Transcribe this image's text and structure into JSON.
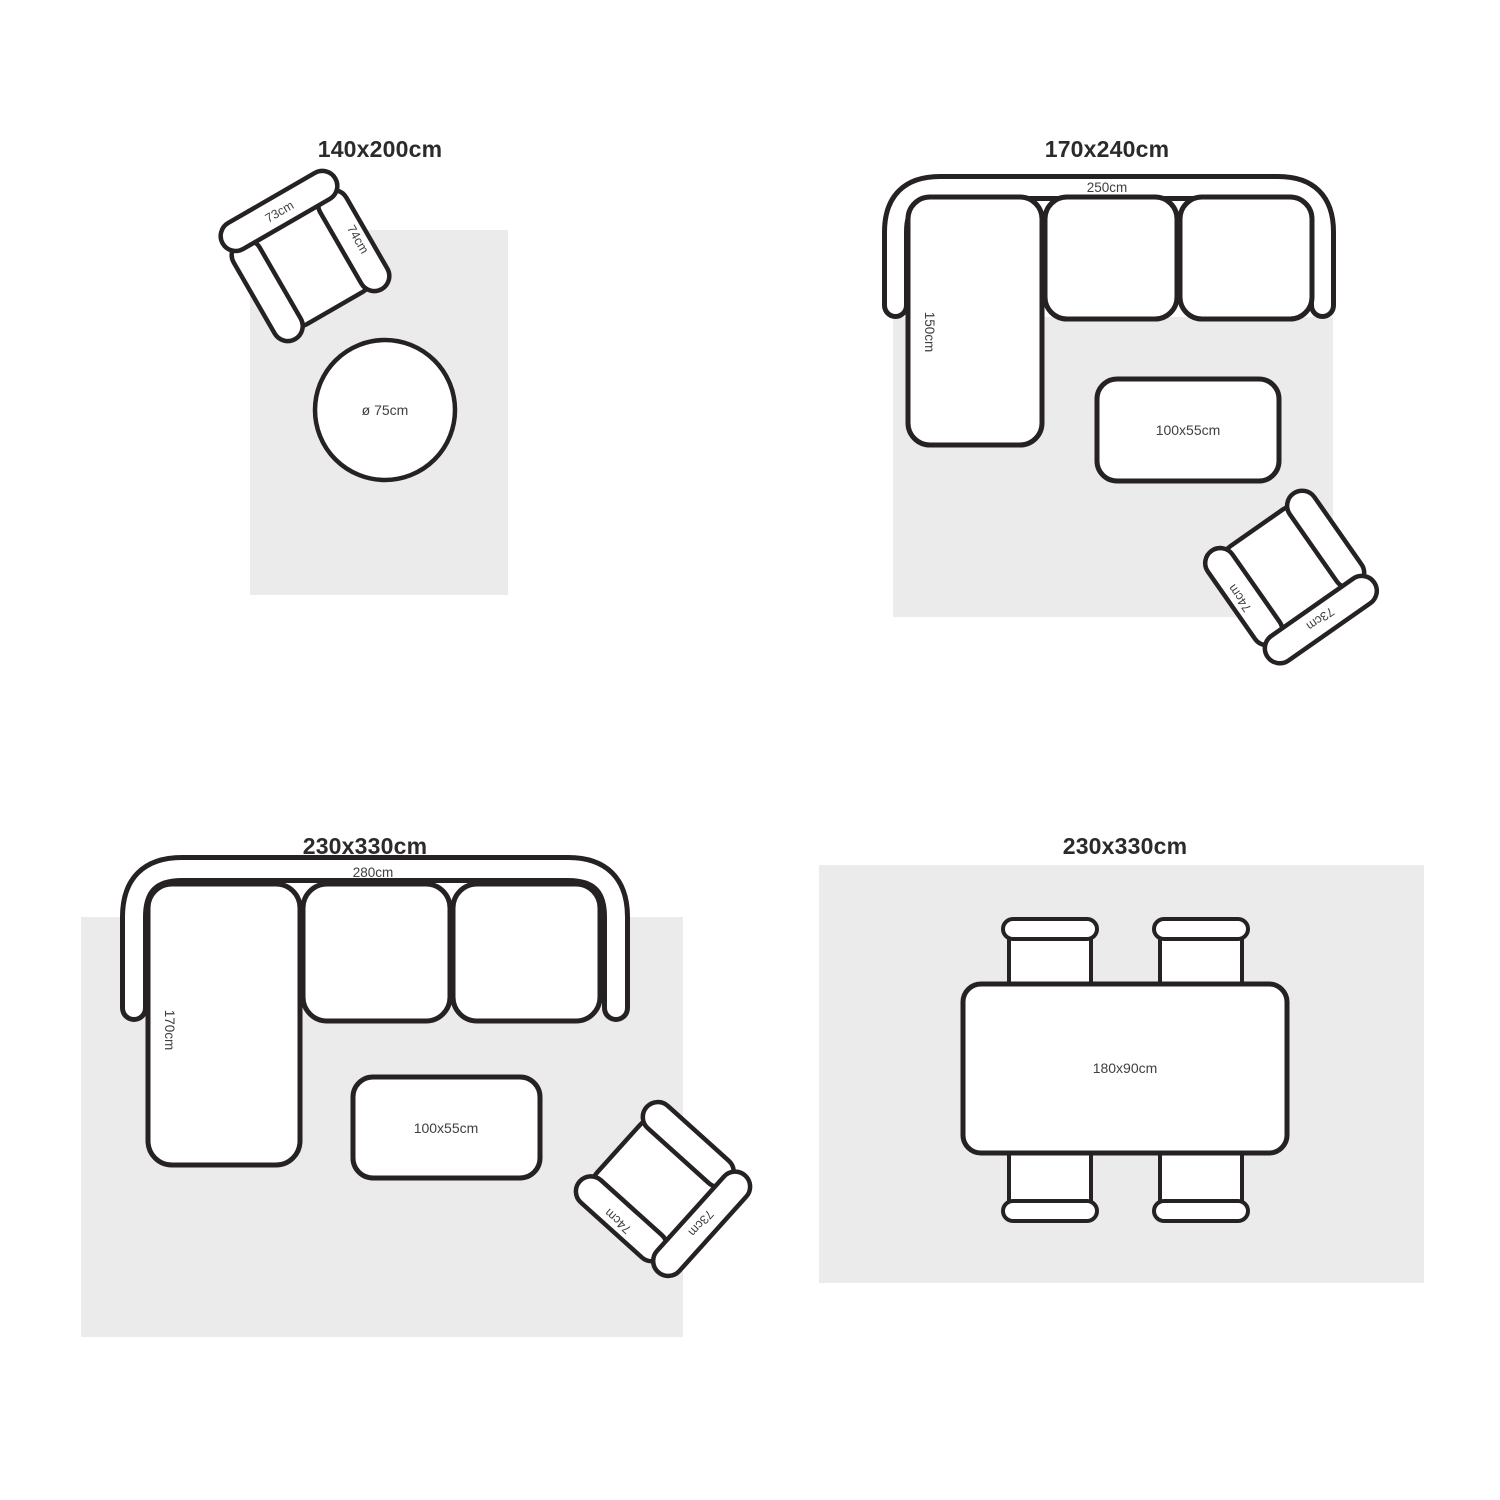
{
  "canvas": {
    "width": 1500,
    "height": 1500,
    "background": "#ffffff"
  },
  "colors": {
    "line": "#262223",
    "rug": "#ebebeb",
    "label": "#3f3f3f",
    "title": "#2b2b2b"
  },
  "quadrants": [
    {
      "id": "top-left",
      "title": "140x200cm",
      "armchair": {
        "back_label": "73cm",
        "arm_label": "74cm"
      },
      "round_table_label": "ø 75cm"
    },
    {
      "id": "top-right",
      "title": "170x240cm",
      "sofa": {
        "width_label": "250cm",
        "depth_label": "150cm"
      },
      "coffee_table_label": "100x55cm",
      "armchair": {
        "back_label": "73cm",
        "arm_label": "74cm"
      }
    },
    {
      "id": "bottom-left",
      "title": "230x330cm",
      "sofa": {
        "width_label": "280cm",
        "depth_label": "170cm"
      },
      "coffee_table_label": "100x55cm",
      "armchair": {
        "back_label": "73cm",
        "arm_label": "74cm"
      }
    },
    {
      "id": "bottom-right",
      "title": "230x330cm",
      "dining_table_label": "180x90cm"
    }
  ]
}
